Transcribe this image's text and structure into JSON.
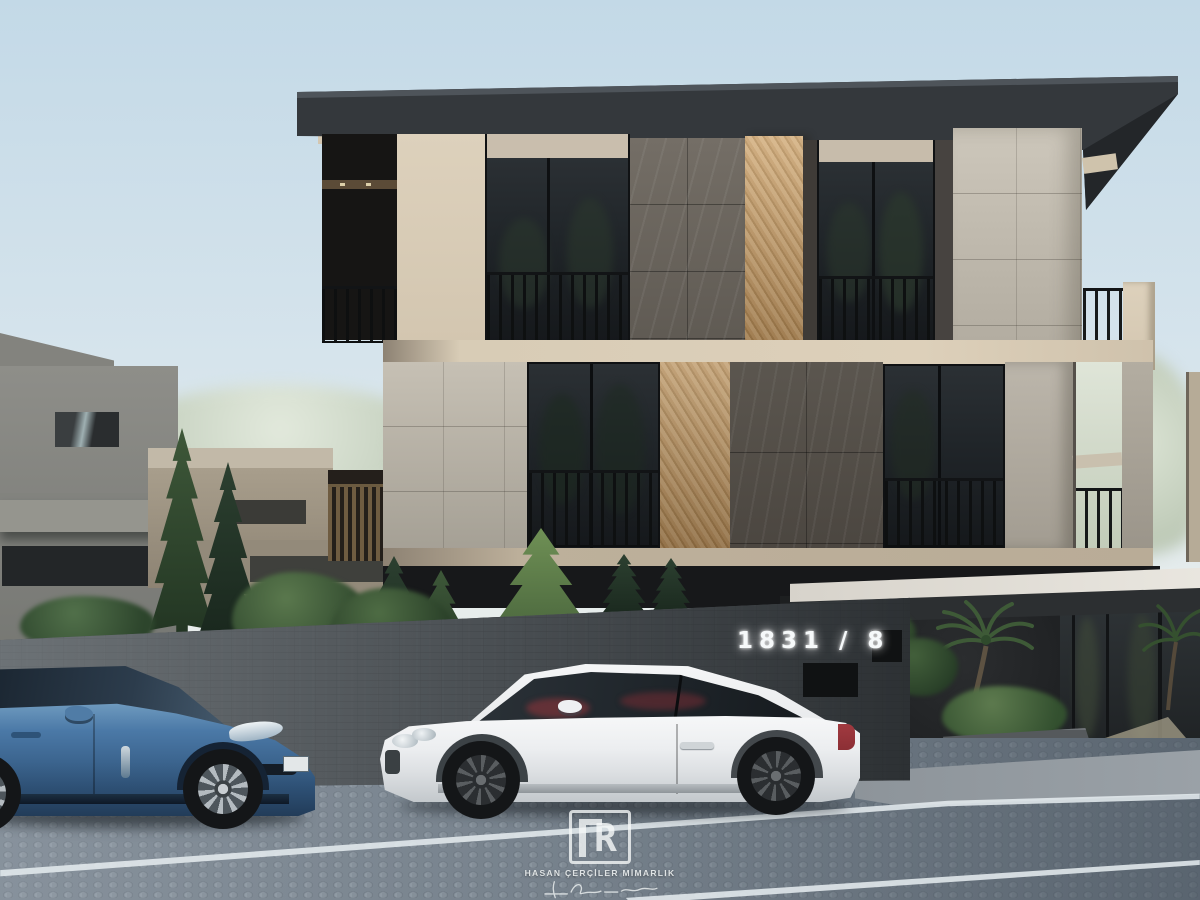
{
  "scene": {
    "signage": {
      "house_number": "1831 / 8"
    },
    "watermark": {
      "monogram": "R",
      "firm_name": "HASAN ÇERÇİLER MİMARLIK"
    }
  },
  "palette": {
    "sky_top": "#c3d9e7",
    "sky_horizon": "#f0f1ed",
    "roof": "#34383c",
    "facade_cream": "#d3c6b0",
    "stone_light": "#c6c0b4",
    "marble_dark": "#5f5a53",
    "wood_slat": "#cda97a",
    "glass_dark": "#1d2226",
    "railing_black": "#121416",
    "neighbor_gray": "#868681",
    "neighbor_beige": "#a89e8c",
    "boundary_wall": "#4a4f53",
    "canopy_white": "#e9e6df",
    "road_light": "#8f99a3",
    "road_dark": "#5b6670",
    "road_line": "#e4ebee",
    "sidewalk": "#9aa1a7",
    "car_blue": "#4b79a7",
    "car_white": "#eceef0",
    "tail_light_red": "#8c2f35",
    "foliage_dark": "#2c4030",
    "foliage_bright": "#6f9055",
    "foliage_washed": "#ccd6c6",
    "number_glow": "#f6f9fa"
  }
}
